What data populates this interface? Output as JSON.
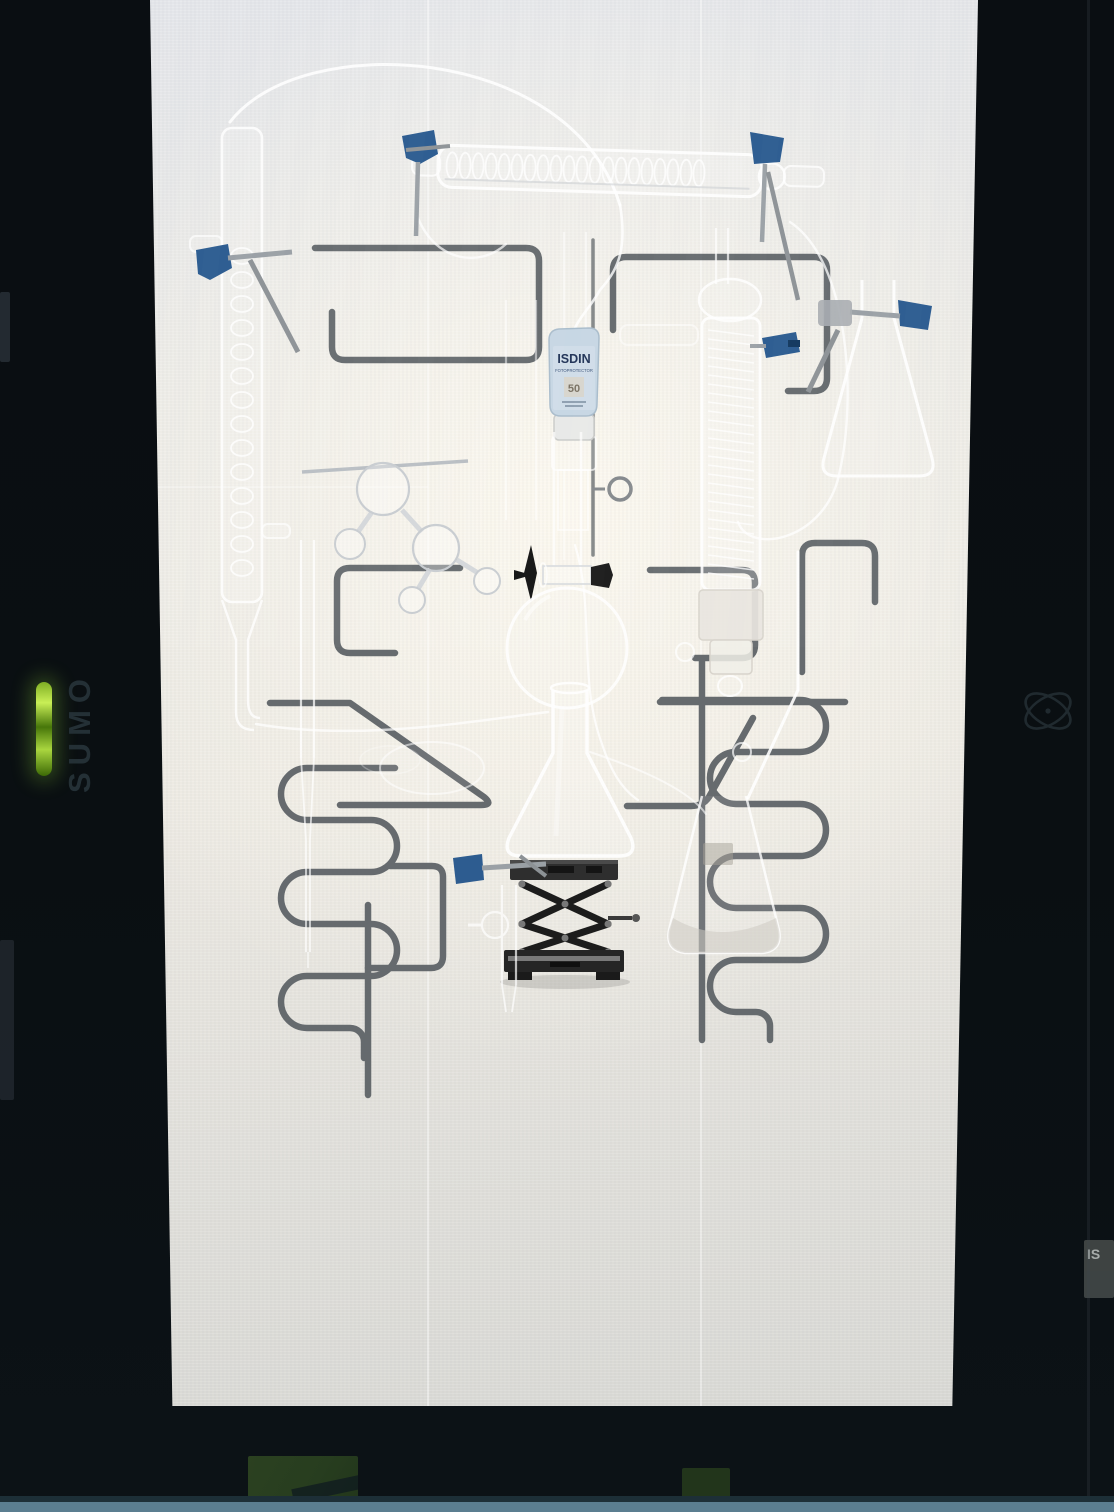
{
  "monitor": {
    "brand_label": "SUMO",
    "power_led_color": "#a6d63b",
    "side_sticker_label": "IS",
    "table_edge_color": "#5b7e90"
  },
  "scene": {
    "bottle_brand": "ISDIN",
    "bottle_subline": "FOTOPROTECTOR",
    "bottle_spf": "50",
    "clamp_color": "#2d5c90",
    "rod_color": "#5f6468"
  }
}
